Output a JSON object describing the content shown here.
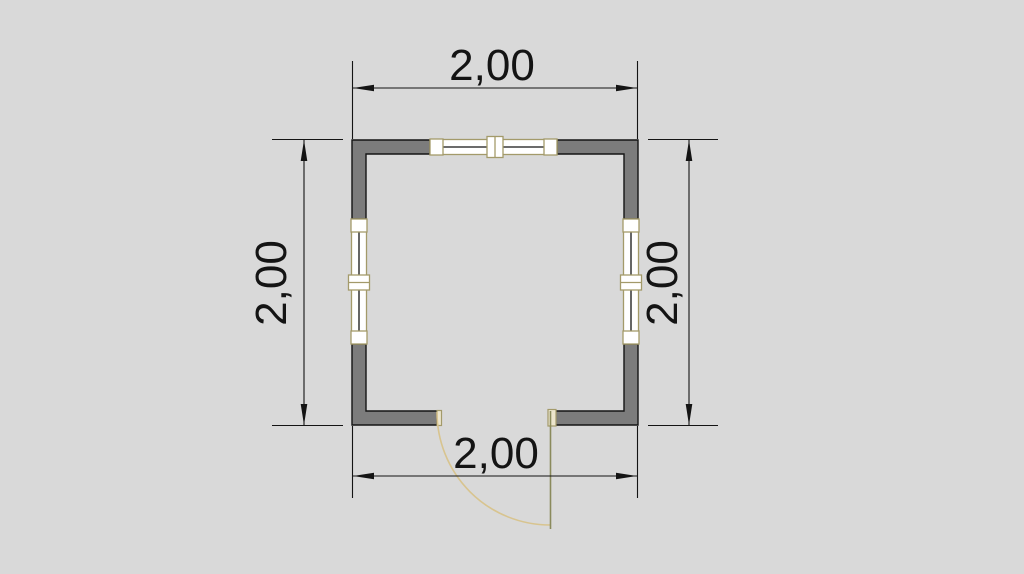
{
  "drawing": {
    "type": "floor-plan",
    "dimensions": {
      "top": "2,00",
      "bottom": "2,00",
      "left": "2,00",
      "right": "2,00"
    },
    "colors": {
      "background": "#d9d9d9",
      "wall_fill": "#7c7c7c",
      "line": "#141414",
      "window_frame": "#a39a6a",
      "window_fill": "#ffffff",
      "jamb_fill": "#ece5cd",
      "door_arc": "#d8c48f",
      "door_leaf": "#8a8a5c"
    }
  }
}
